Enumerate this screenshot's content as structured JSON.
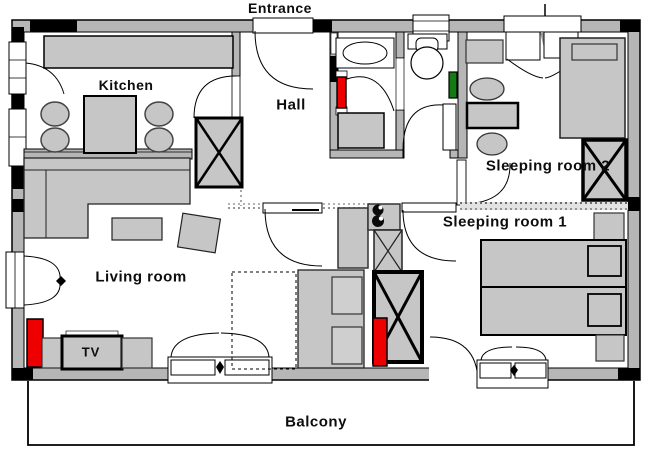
{
  "title": "Apartment floor plan",
  "labels": {
    "entrance": "Entrance",
    "kitchen": "Kitchen",
    "hall": "Hall",
    "sleeping_room_2": "Sleeping room 2",
    "sleeping_room_1": "Sleeping room 1",
    "living_room": "Living room",
    "tv": "TV",
    "balcony": "Balcony"
  },
  "colors": {
    "background": "#ffffff",
    "wall_fill": "#b6b6b6",
    "furniture_fill": "#c6c6c6",
    "line": "#000000",
    "radiator_red": "#ee0000",
    "towel_rail_green": "#157a15",
    "dashed_boundary": "#777777"
  },
  "rooms": [
    {
      "name": "Kitchen",
      "items": [
        "counter",
        "dining-table",
        "four-stools",
        "window"
      ]
    },
    {
      "name": "Hall",
      "items": [
        "entrance-door",
        "wardrobe",
        "tall-cabinet"
      ]
    },
    {
      "name": "Bathroom-WC",
      "items": [
        "washbasin",
        "toilet",
        "washing-machine",
        "radiator",
        "towel-rail",
        "window"
      ]
    },
    {
      "name": "Sleeping room 2",
      "items": [
        "single-bed",
        "wardrobe",
        "desk",
        "two-stools",
        "dresser",
        "balcony-door"
      ]
    },
    {
      "name": "Sleeping room 1",
      "items": [
        "double-bed",
        "wardrobe",
        "two-nightstands",
        "radiator",
        "balcony-door"
      ]
    },
    {
      "name": "Living room",
      "items": [
        "corner-sofa",
        "coffee-table",
        "armchair",
        "sofa-bed",
        "tv-stand",
        "radiator",
        "french-window",
        "balcony-door"
      ]
    },
    {
      "name": "Balcony",
      "items": []
    }
  ]
}
